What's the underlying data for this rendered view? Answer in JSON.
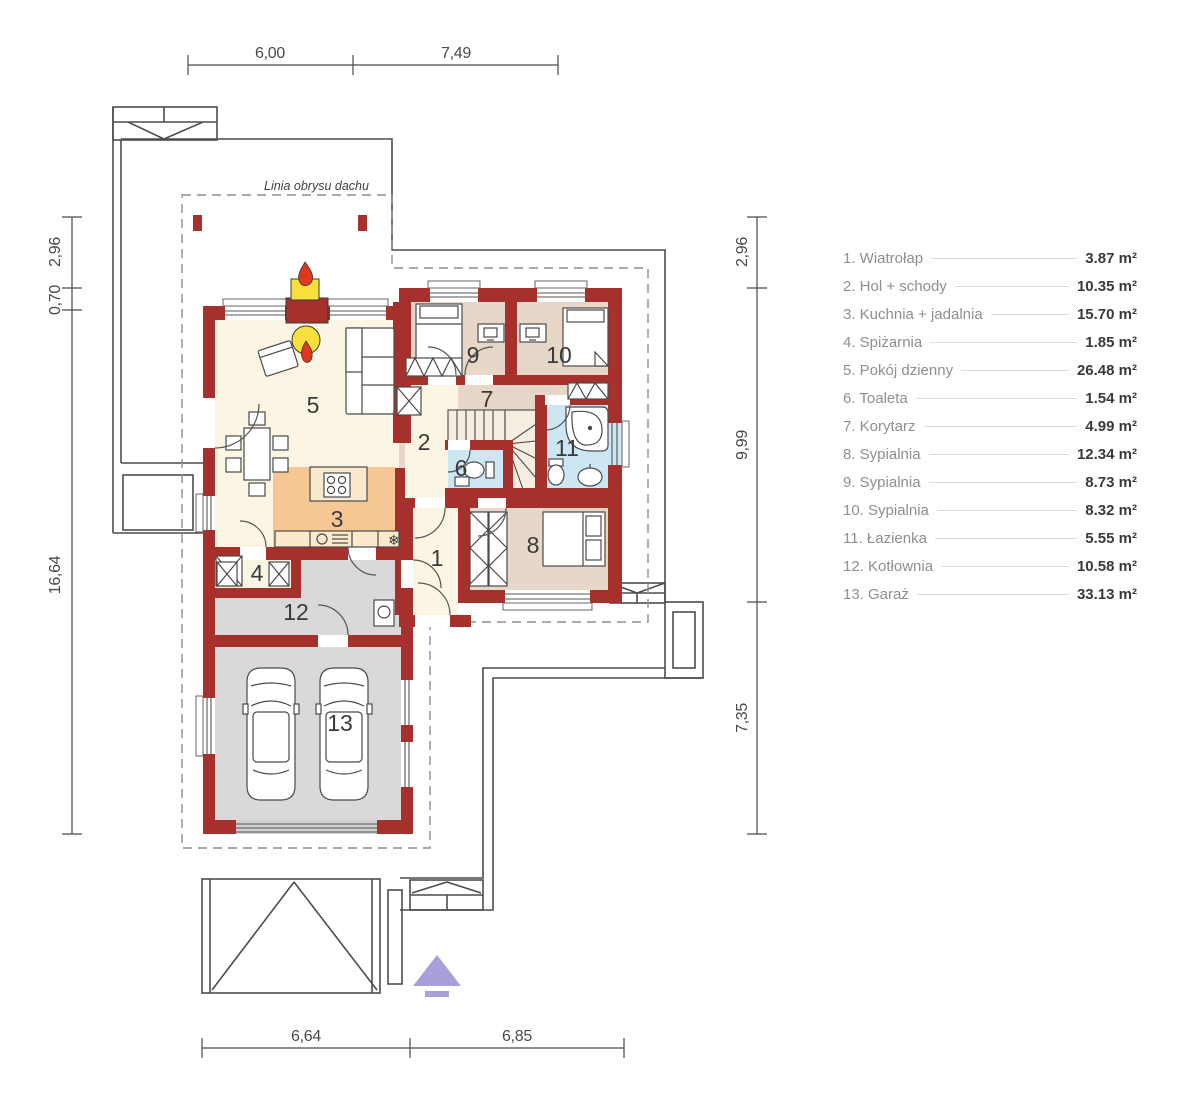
{
  "plan": {
    "roof_outline_label": "Linia obrysu dachu",
    "room_numbers": [
      "1",
      "2",
      "3",
      "4",
      "5",
      "6",
      "7",
      "8",
      "9",
      "10",
      "11",
      "12",
      "13"
    ],
    "dimensions": {
      "top": [
        "6,00",
        "7,49"
      ],
      "bottom": [
        "6,64",
        "6,85"
      ],
      "left": [
        "2,96",
        "0,70",
        "16,64"
      ],
      "right": [
        "2,96",
        "9,99",
        "7,35"
      ]
    },
    "fridge_symbol": "❄"
  },
  "legend": {
    "items": [
      {
        "label": "1. Wiatrołap",
        "area": "3.87 m²"
      },
      {
        "label": "2. Hol + schody",
        "area": "10.35 m²"
      },
      {
        "label": "3. Kuchnia + jadalnia",
        "area": "15.70 m²"
      },
      {
        "label": "4. Spiżarnia",
        "area": "1.85 m²"
      },
      {
        "label": "5. Pokój dzienny",
        "area": "26.48 m²"
      },
      {
        "label": "6. Toaleta",
        "area": "1.54 m²"
      },
      {
        "label": "7. Korytarz",
        "area": "4.99 m²"
      },
      {
        "label": "8. Sypialnia",
        "area": "12.34 m²"
      },
      {
        "label": "9. Sypialnia",
        "area": "8.73 m²"
      },
      {
        "label": "10. Sypialnia",
        "area": "8.32 m²"
      },
      {
        "label": "11. Łazienka",
        "area": "5.55 m²"
      },
      {
        "label": "12. Kotłownia",
        "area": "10.58 m²"
      },
      {
        "label": "13. Garaż",
        "area": "33.13 m²"
      }
    ]
  },
  "colors": {
    "wall_red": "#A5302C",
    "flame_red": "#E0371F",
    "fire_yellow": "#F7E03C",
    "living_floor_cream": "#FBF5E4",
    "kitchen_floor_orange": "#F6C795",
    "bedroom_floor_tan": "#E6D7C8",
    "bath_floor_blue": "#CDE6F4",
    "garage_floor_gray": "#D9D9D9",
    "entrance_arrow_purple": "#A8A0DB",
    "outline_gray": "#4D4D4D"
  }
}
